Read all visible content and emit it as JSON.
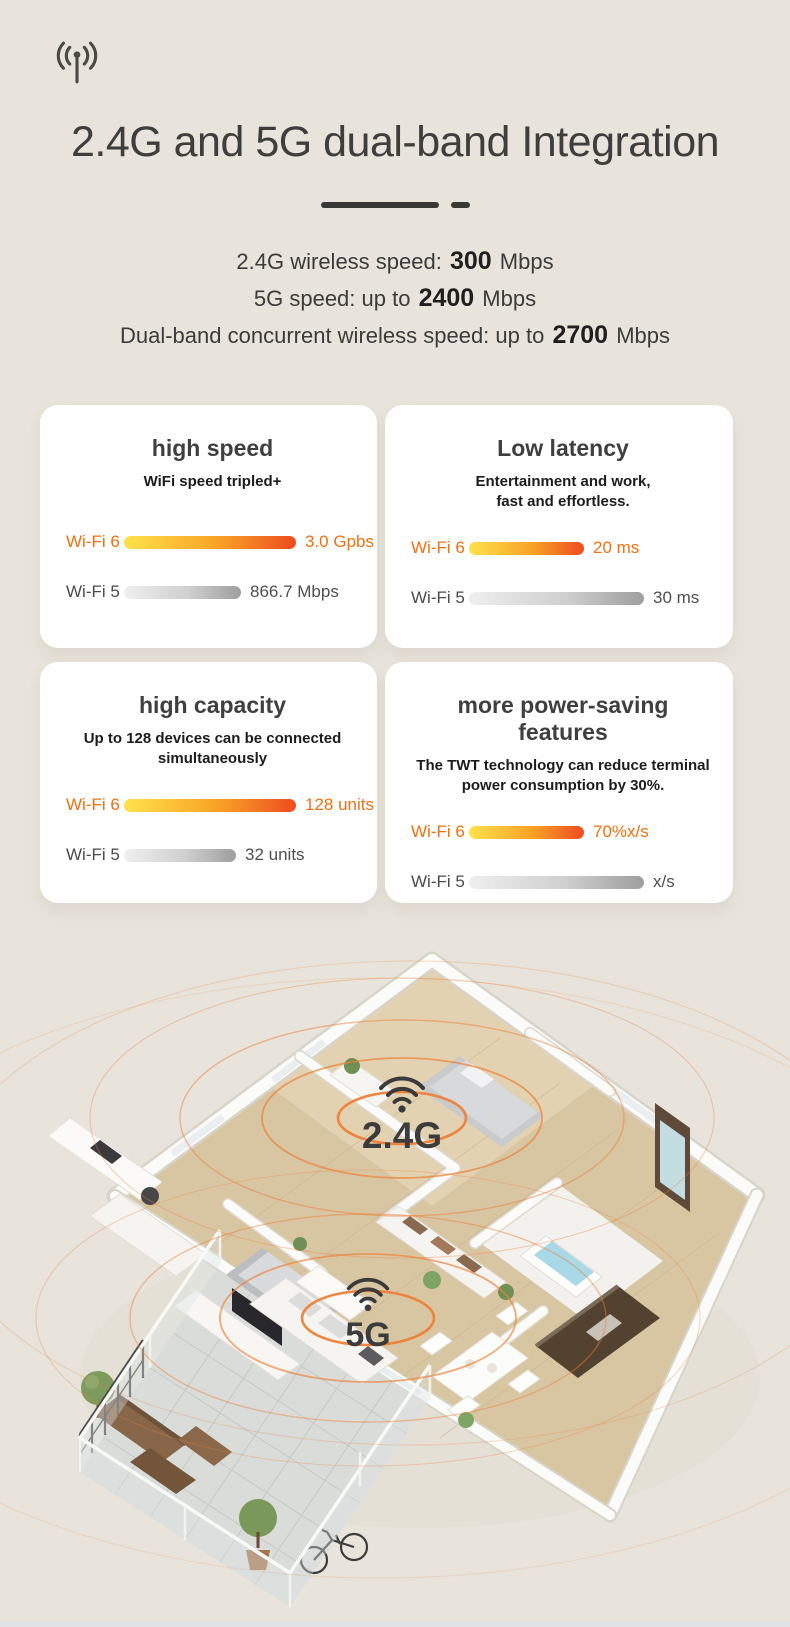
{
  "theme": {
    "background": "#E8E4DB",
    "accent_orange": "#F2700F",
    "ring_orange": "#EE8038",
    "wifi6_bar_gradient": [
      "#FFE24A",
      "#F8A226",
      "#EF4B20"
    ],
    "wifi5_bar_gradient": [
      "#EFEFEF",
      "#CFCFCF",
      "#9E9E9E"
    ],
    "title_color": "#3E3E3E",
    "bottom_strip_color": "#DFE3E4"
  },
  "header": {
    "icon": "antenna-signal-icon",
    "title": "2.4G and 5G dual-band Integration",
    "specs": [
      {
        "prefix": "2.4G wireless speed: ",
        "value": "300",
        "suffix": " Mbps"
      },
      {
        "prefix": "5G speed: up to ",
        "value": "2400",
        "suffix": " Mbps"
      },
      {
        "prefix": "Dual-band concurrent wireless speed: up to ",
        "value": "2700",
        "suffix": " Mbps"
      }
    ]
  },
  "cards": [
    {
      "title": "high speed",
      "subtitle_lines": [
        "WiFi speed tripled+"
      ],
      "rows": [
        {
          "label": "Wi-Fi 6",
          "value": "3.0 Gpbs",
          "width_px": 172,
          "style": "wifi6"
        },
        {
          "label": "Wi-Fi 5",
          "value": "866.7 Mbps",
          "width_px": 117,
          "style": "wifi5"
        }
      ]
    },
    {
      "title": "Low latency",
      "subtitle_lines": [
        "Entertainment and work,",
        "fast and effortless."
      ],
      "rows": [
        {
          "label": "Wi-Fi 6",
          "value": "20 ms",
          "width_px": 115,
          "style": "wifi6"
        },
        {
          "label": "Wi-Fi 5",
          "value": "30 ms",
          "width_px": 175,
          "style": "wifi5"
        }
      ]
    },
    {
      "title": "high capacity",
      "subtitle_lines": [
        "Up to 128 devices can be connected",
        "simultaneously"
      ],
      "rows": [
        {
          "label": "Wi-Fi 6",
          "value": "128 units",
          "width_px": 172,
          "style": "wifi6"
        },
        {
          "label": "Wi-Fi 5",
          "value": "32 units",
          "width_px": 112,
          "style": "wifi5"
        }
      ]
    },
    {
      "title": "more power-saving features",
      "subtitle_lines": [
        "The TWT technology can reduce terminal",
        "power consumption by 30%."
      ],
      "rows": [
        {
          "label": "Wi-Fi 6",
          "value": "70%x/s",
          "width_px": 115,
          "style": "wifi6"
        },
        {
          "label": "Wi-Fi 5",
          "value": "x/s",
          "width_px": 175,
          "style": "wifi5"
        }
      ]
    }
  ],
  "floorplan": {
    "description": "isometric apartment cutaway with wifi coverage rings",
    "band_labels": [
      {
        "text": "2.4G"
      },
      {
        "text": "5G"
      }
    ]
  }
}
